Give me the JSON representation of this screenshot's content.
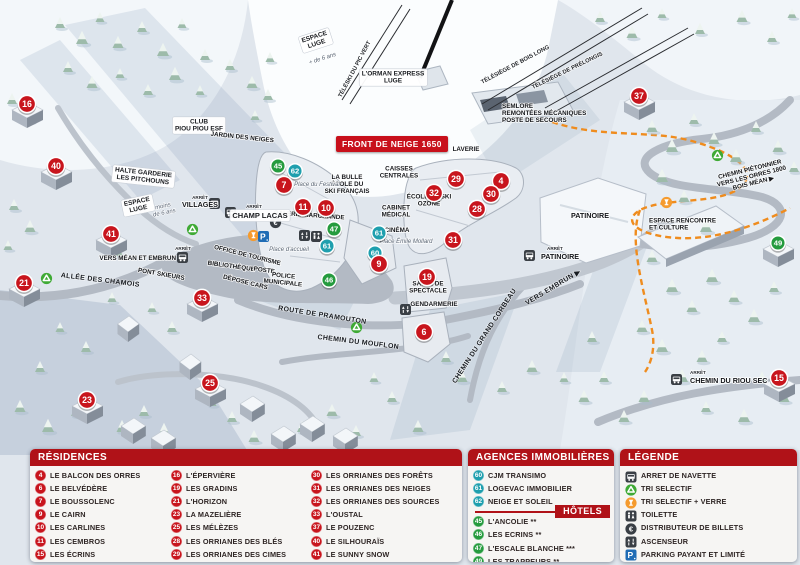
{
  "map": {
    "banner": "FRONT DE NEIGE 1650",
    "colors": {
      "residence": "#c8151d",
      "agency": "#1f9fae",
      "hotel": "#259b3e",
      "header_red": "#b01218",
      "parking_blue": "#1f6cb5",
      "glass_orange": "#f59b2e",
      "recycle_green": "#3faa35",
      "dark": "#3a3f45"
    },
    "markers": [
      {
        "n": "16",
        "c": "residence",
        "x": 27,
        "y": 104,
        "b": true
      },
      {
        "n": "40",
        "c": "residence",
        "x": 56,
        "y": 166,
        "b": true
      },
      {
        "n": "41",
        "c": "residence",
        "x": 111,
        "y": 234,
        "b": true
      },
      {
        "n": "21",
        "c": "residence",
        "x": 24,
        "y": 283,
        "b": true
      },
      {
        "n": "33",
        "c": "residence",
        "x": 202,
        "y": 298,
        "b": true
      },
      {
        "n": "23",
        "c": "residence",
        "x": 87,
        "y": 400,
        "b": true
      },
      {
        "n": "25",
        "c": "residence",
        "x": 210,
        "y": 383,
        "b": true
      },
      {
        "n": "37",
        "c": "residence",
        "x": 639,
        "y": 96,
        "b": true
      },
      {
        "n": "15",
        "c": "residence",
        "x": 779,
        "y": 378,
        "b": true
      },
      {
        "n": "6",
        "c": "residence",
        "x": 424,
        "y": 332,
        "b": false
      },
      {
        "n": "49",
        "c": "hotel",
        "x": 778,
        "y": 243,
        "b": true
      },
      {
        "n": "45",
        "c": "hotel",
        "x": 278,
        "y": 166,
        "b": false
      },
      {
        "n": "62",
        "c": "agency",
        "x": 295,
        "y": 171,
        "b": false
      },
      {
        "n": "7",
        "c": "residence",
        "x": 284,
        "y": 185,
        "b": false
      },
      {
        "n": "11",
        "c": "residence",
        "x": 303,
        "y": 207,
        "b": false
      },
      {
        "n": "10",
        "c": "residence",
        "x": 326,
        "y": 208,
        "b": false
      },
      {
        "n": "47",
        "c": "hotel",
        "x": 334,
        "y": 229,
        "b": false
      },
      {
        "n": "61",
        "c": "agency",
        "x": 327,
        "y": 246,
        "b": false
      },
      {
        "n": "61",
        "c": "agency",
        "x": 379,
        "y": 233,
        "b": false
      },
      {
        "n": "60",
        "c": "agency",
        "x": 375,
        "y": 253,
        "b": false
      },
      {
        "n": "9",
        "c": "residence",
        "x": 379,
        "y": 264,
        "b": false
      },
      {
        "n": "46",
        "c": "hotel",
        "x": 329,
        "y": 280,
        "b": false
      },
      {
        "n": "29",
        "c": "residence",
        "x": 456,
        "y": 179,
        "b": false
      },
      {
        "n": "4",
        "c": "residence",
        "x": 501,
        "y": 181,
        "b": false
      },
      {
        "n": "32",
        "c": "residence",
        "x": 434,
        "y": 193,
        "b": false
      },
      {
        "n": "30",
        "c": "residence",
        "x": 491,
        "y": 194,
        "b": false
      },
      {
        "n": "28",
        "c": "residence",
        "x": 477,
        "y": 209,
        "b": false
      },
      {
        "n": "31",
        "c": "residence",
        "x": 453,
        "y": 240,
        "b": false
      },
      {
        "n": "19",
        "c": "residence",
        "x": 427,
        "y": 277,
        "b": false
      }
    ],
    "icons": [
      {
        "t": "bus",
        "x": 215,
        "y": 204
      },
      {
        "t": "bus",
        "x": 231,
        "y": 213
      },
      {
        "t": "bus",
        "x": 183,
        "y": 258
      },
      {
        "t": "bus",
        "x": 530,
        "y": 256
      },
      {
        "t": "bus",
        "x": 677,
        "y": 380
      },
      {
        "t": "recycle",
        "x": 193,
        "y": 230
      },
      {
        "t": "recycle",
        "x": 47,
        "y": 279
      },
      {
        "t": "recycle",
        "x": 357,
        "y": 328
      },
      {
        "t": "recycle",
        "x": 718,
        "y": 156
      },
      {
        "t": "glass",
        "x": 254,
        "y": 236
      },
      {
        "t": "glass",
        "x": 667,
        "y": 203
      },
      {
        "t": "parking",
        "x": 264,
        "y": 237
      },
      {
        "t": "euro",
        "x": 276,
        "y": 223
      },
      {
        "t": "elevator",
        "x": 305,
        "y": 236
      },
      {
        "t": "elevator",
        "x": 406,
        "y": 310
      },
      {
        "t": "wc",
        "x": 317,
        "y": 237
      }
    ],
    "labels": [
      {
        "t": "L'ORMAN EXPRESS\nLUGE",
        "x": 393,
        "y": 79,
        "c": "pill"
      },
      {
        "t": "TÉLÉSKI DU PIC VERT",
        "x": 356,
        "y": 70,
        "r": -62,
        "c": "lift"
      },
      {
        "t": "TÉLÉSIÈGE DE BOIS LONG",
        "x": 516,
        "y": 66,
        "r": -28,
        "c": "lift"
      },
      {
        "t": "TÉLÉSIÈGE DE PRÉLONGIS",
        "x": 568,
        "y": 72,
        "r": -26,
        "c": "lift"
      },
      {
        "t": "SEMLORE\nREMONTÉES MÉCANIQUES\nPOSTE DE SECOURS",
        "x": 502,
        "y": 115,
        "c": "poi",
        "a": "start"
      },
      {
        "t": "LAVERIE",
        "x": 466,
        "y": 151,
        "c": "poi"
      },
      {
        "t": "CAISSES\nCENTRALES",
        "x": 399,
        "y": 174,
        "c": "poi"
      },
      {
        "t": "LA BULLE\nÉCOLE DU\nSKI FRANÇAIS",
        "x": 347,
        "y": 186,
        "c": "poi"
      },
      {
        "t": "ÉCOLE DE SKI\nOZONE",
        "x": 429,
        "y": 202,
        "c": "poi"
      },
      {
        "t": "CABINET\nMÉDICAL",
        "x": 396,
        "y": 213,
        "c": "poi"
      },
      {
        "t": "CINÉMA",
        "x": 397,
        "y": 232,
        "c": "poi"
      },
      {
        "t": "GALERIE MARCHANDE",
        "x": 309,
        "y": 217,
        "r": 4,
        "c": "poi"
      },
      {
        "t": "Place du Festival",
        "x": 317,
        "y": 186,
        "c": "place"
      },
      {
        "t": "Place d'accueil",
        "x": 289,
        "y": 251,
        "c": "place"
      },
      {
        "t": "Place Émile Mollard",
        "x": 406,
        "y": 243,
        "c": "place"
      },
      {
        "t": "CLUB\nPIOU PIOU ESF",
        "x": 199,
        "y": 127,
        "c": "pill"
      },
      {
        "t": "JARDIN DES NEIGES",
        "x": 242,
        "y": 139,
        "r": 6,
        "c": "poi"
      },
      {
        "t": "HALTE GARDERIE\nLES PITCHOUNS",
        "x": 143,
        "y": 178,
        "r": 6,
        "c": "pill"
      },
      {
        "t": "ESPACE\nLUGE",
        "x": 316,
        "y": 42,
        "r": -18,
        "c": "pill"
      },
      {
        "t": "+ de 6 ans",
        "x": 323,
        "y": 60,
        "r": -18,
        "c": "place"
      },
      {
        "t": "ESPACE\nLUGE",
        "x": 138,
        "y": 207,
        "r": -12,
        "c": "pill"
      },
      {
        "t": "moins\nde 6 ans",
        "x": 164,
        "y": 211,
        "r": -12,
        "c": "place"
      },
      {
        "t": "ARRÊT",
        "x": 200,
        "y": 199,
        "c": "tiny"
      },
      {
        "t": "VILLAGES",
        "x": 200,
        "y": 207,
        "c": "poil"
      },
      {
        "t": "ARRÊT",
        "x": 254,
        "y": 208,
        "c": "tiny"
      },
      {
        "t": "CHAMP LACAS",
        "x": 260,
        "y": 218,
        "c": "pilll"
      },
      {
        "t": "VERS MÉAN ET EMBRUN",
        "x": 176,
        "y": 260,
        "c": "poi",
        "a": "end"
      },
      {
        "t": "ARRÊT",
        "x": 183,
        "y": 250,
        "c": "tiny"
      },
      {
        "t": "PONT SKIEURS",
        "x": 161,
        "y": 276,
        "r": 10,
        "c": "poi"
      },
      {
        "t": "ALLÉE DES CHAMOIS",
        "x": 100,
        "y": 282,
        "r": 7,
        "c": "road"
      },
      {
        "t": "OFFICE DE TOURISME",
        "x": 247,
        "y": 257,
        "r": 14,
        "c": "poi"
      },
      {
        "t": "BIBLIOTHÈQUE",
        "x": 231,
        "y": 268,
        "r": 8,
        "c": "poi"
      },
      {
        "t": "POSTE",
        "x": 264,
        "y": 272,
        "r": 8,
        "c": "poi"
      },
      {
        "t": "DÉPOSE CARS",
        "x": 245,
        "y": 284,
        "r": 14,
        "c": "poi"
      },
      {
        "t": "POLICE\nMUNICIPALE",
        "x": 283,
        "y": 281,
        "r": 6,
        "c": "poi"
      },
      {
        "t": "ROUTE DE PRAMOUTON",
        "x": 322,
        "y": 317,
        "r": 9,
        "c": "road"
      },
      {
        "t": "CHEMIN DU MOUFLON",
        "x": 358,
        "y": 344,
        "r": 7,
        "c": "road"
      },
      {
        "t": "CHEMIN DU GRAND CORBEAU",
        "x": 486,
        "y": 337,
        "r": -57,
        "c": "road"
      },
      {
        "t": "VERS EMBRUN ▶",
        "x": 554,
        "y": 289,
        "r": -31,
        "c": "road"
      },
      {
        "t": "SALLE DE\nSPECTACLE",
        "x": 428,
        "y": 289,
        "c": "poi"
      },
      {
        "t": "GENDARMERIE",
        "x": 434,
        "y": 306,
        "c": "poi"
      },
      {
        "t": "PATINOIRE",
        "x": 590,
        "y": 218,
        "c": "poil"
      },
      {
        "t": "ARRÊT",
        "x": 547,
        "y": 250,
        "c": "tiny",
        "a": "start"
      },
      {
        "t": "PATINOIRE",
        "x": 541,
        "y": 259,
        "c": "poil",
        "a": "start"
      },
      {
        "t": "ESPACE RENCONTRE\nET CULTURE",
        "x": 649,
        "y": 226,
        "c": "poi",
        "a": "start"
      },
      {
        "t": "CHEMIN PIÉTONNIER\nVERS LES ORRES 1800\nBOIS MÉAN ▶",
        "x": 752,
        "y": 178,
        "r": -14,
        "c": "poi"
      },
      {
        "t": "ARRÊT",
        "x": 690,
        "y": 374,
        "c": "tiny",
        "a": "start"
      },
      {
        "t": "CHEMIN DU RIOU SEC",
        "x": 690,
        "y": 383,
        "c": "poil",
        "a": "start"
      }
    ]
  },
  "legend": {
    "residences": {
      "title": "RÉSIDENCES",
      "items": [
        {
          "num": "4",
          "label": "LE BALCON DES ORRES"
        },
        {
          "num": "6",
          "label": "LE BELVÉDÈRE"
        },
        {
          "num": "7",
          "label": "LE BOUSSOLENC"
        },
        {
          "num": "9",
          "label": "LE CAIRN"
        },
        {
          "num": "10",
          "label": "LES CARLINES"
        },
        {
          "num": "11",
          "label": "LES CEMBROS"
        },
        {
          "num": "15",
          "label": "LES ÉCRINS"
        },
        {
          "num": "16",
          "label": "L'ÉPERVIÈRE"
        },
        {
          "num": "19",
          "label": "LES GRADINS"
        },
        {
          "num": "21",
          "label": "L'HORIZON"
        },
        {
          "num": "23",
          "label": "LA MAZELIÈRE"
        },
        {
          "num": "25",
          "label": "LES MÉLÈZES"
        },
        {
          "num": "28",
          "label": "LES ORRIANES DES BLÉS"
        },
        {
          "num": "29",
          "label": "LES ORRIANES DES CIMES"
        },
        {
          "num": "30",
          "label": "LES ORRIANES DES FORÊTS"
        },
        {
          "num": "31",
          "label": "LES ORRIANES DES NEIGES"
        },
        {
          "num": "32",
          "label": "LES ORRIANES DES SOURCES"
        },
        {
          "num": "33",
          "label": "L'OUSTAL"
        },
        {
          "num": "37",
          "label": "LE POUZENC"
        },
        {
          "num": "40",
          "label": "LE SILHOURAÏS"
        },
        {
          "num": "41",
          "label": "LE SUNNY SNOW"
        }
      ]
    },
    "agencies": {
      "title": "AGENCES IMMOBILIÈRES",
      "items": [
        {
          "num": "60",
          "label": "CJM TRANSIMO"
        },
        {
          "num": "61",
          "label": "LOGEVAC IMMOBILIER"
        },
        {
          "num": "62",
          "label": "NEIGE ET SOLEIL"
        }
      ]
    },
    "hotels": {
      "title": "HÔTELS",
      "items": [
        {
          "num": "45",
          "label": "L'ANCOLIE **"
        },
        {
          "num": "46",
          "label": "LES ECRINS **"
        },
        {
          "num": "47",
          "label": "L'ESCALE BLANCHE ***"
        },
        {
          "num": "49",
          "label": "LES TRAPPEURS **"
        }
      ]
    },
    "legende": {
      "title": "LÉGENDE",
      "items": [
        {
          "icon": "bus",
          "label": "ARRET DE NAVETTE"
        },
        {
          "icon": "recycle",
          "label": "TRI SELECTIF"
        },
        {
          "icon": "glass",
          "label": "TRI SELECTIF + VERRE"
        },
        {
          "icon": "wc",
          "label": "TOILETTE"
        },
        {
          "icon": "euro",
          "label": "DISTRIBUTEUR DE BILLETS"
        },
        {
          "icon": "elevator",
          "label": "ASCENSEUR"
        },
        {
          "icon": "parking",
          "label": "PARKING PAYANT ET LIMITÉ"
        }
      ]
    }
  }
}
